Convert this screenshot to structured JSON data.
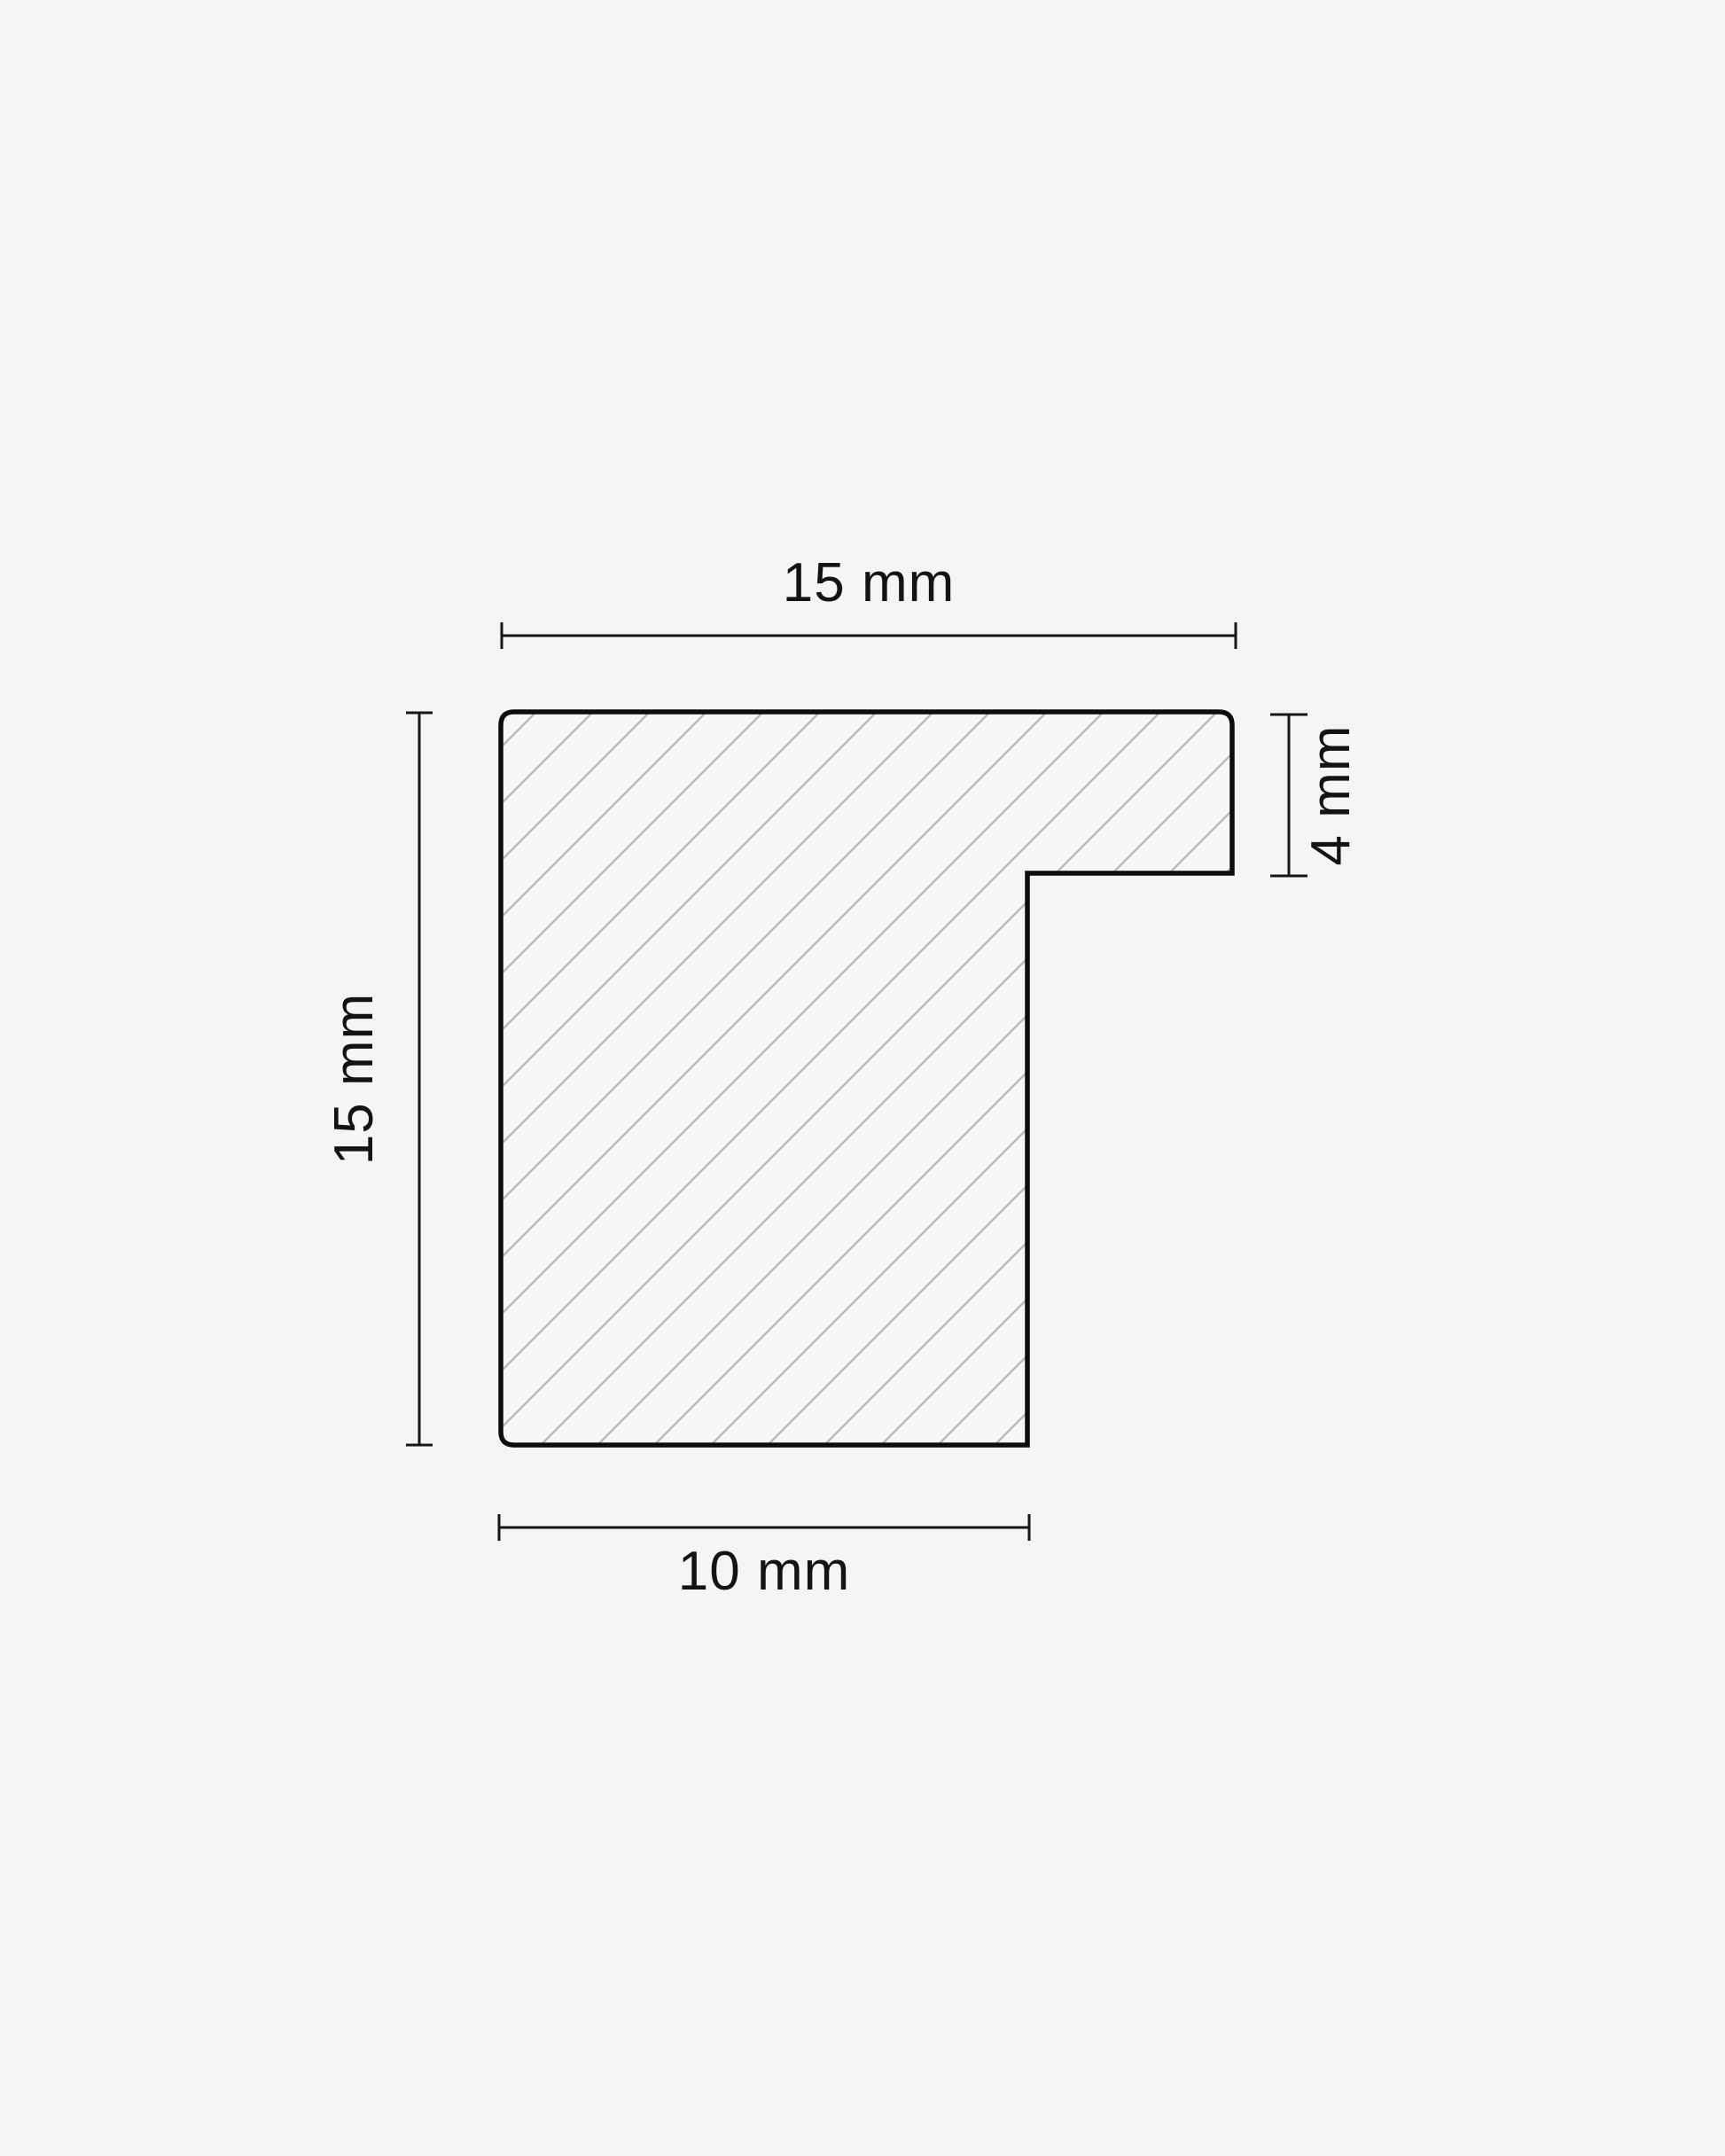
{
  "diagram": {
    "title": "moulding-profile-cross-section",
    "dimensions": {
      "top_width": {
        "value": 15,
        "unit": "mm",
        "label": "15 mm"
      },
      "left_height": {
        "value": 15,
        "unit": "mm",
        "label": "15 mm"
      },
      "right_rebate": {
        "value": 4,
        "unit": "mm",
        "label": "4 mm"
      },
      "bottom_width": {
        "value": 10,
        "unit": "mm",
        "label": "10 mm"
      }
    },
    "colors": {
      "background": "#f5f5f7",
      "profile_fill": "#f6f6f8",
      "outline": "#0d0d0d",
      "hatch": "#b4b4b9",
      "dimension_line": "#161616",
      "text": "#131313"
    }
  }
}
